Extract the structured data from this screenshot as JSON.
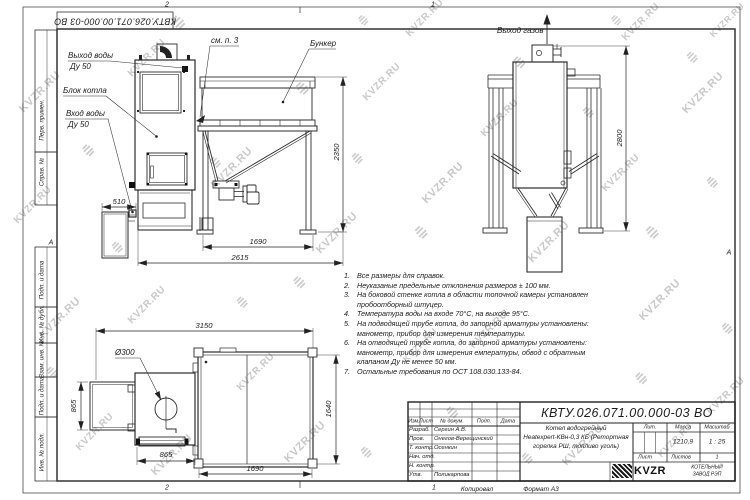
{
  "watermark": {
    "text": "KVZR.RU"
  },
  "frame": {
    "zone_top_left": "2",
    "zone_top_right": "1",
    "zone_bottom_left": "2",
    "zone_bottom_right": "1",
    "side_marker": "А",
    "left_column": [
      "Перв. примен.",
      "Справ. №",
      "Подп. и дата",
      "Инв. № дубл.",
      "Взам. инв. №",
      "Подп. и дата",
      "Инв. № подл."
    ],
    "copied_label": "Копировал",
    "format_label": "Формат А3"
  },
  "views": {
    "front": {
      "labels": {
        "water_out_1": "Выход воды",
        "water_out_2": "Ду 50",
        "boiler_block": "Блок котла",
        "water_in_1": "Вход воды",
        "water_in_2": "Ду 50",
        "see_note": "см. п. 3",
        "bunker": "Бункер"
      },
      "dims": {
        "height": "2350",
        "width_legs": "1690",
        "width_total": "2615",
        "ash_box": "510"
      }
    },
    "side": {
      "labels": {
        "gas_out": "Выход газов"
      },
      "dims": {
        "height": "2800"
      }
    },
    "plan": {
      "labels": {
        "diameter": "Ø300"
      },
      "dims": {
        "width_total": "3150",
        "depth_left": "865",
        "width_small": "865",
        "depth": "1640",
        "width_bunker": "1690"
      }
    }
  },
  "notes": {
    "items": [
      {
        "num": "1.",
        "text": "Все размеры для справок."
      },
      {
        "num": "2.",
        "text": "Неуказаные предельные отклонения размеров ± 100 мм."
      },
      {
        "num": "3.",
        "text": "На боковой стенке котла в области топочной камеры установлен пробоотборный штуцер."
      },
      {
        "num": "4.",
        "text": "Температура воды на входе 70°С, на выходе 95°С."
      },
      {
        "num": "5.",
        "text": "На подводящей трубе котла, до запорной арматуры установлены: манометр, прибор для измерения температуры."
      },
      {
        "num": "6.",
        "text": "На отводящей трубе котла, до запорной арматуры установлены: манометр, прибор для измерения емпературы, обвод с обратным клапаном Ду не менее 50 мм."
      },
      {
        "num": "7.",
        "text": "Остальные требования по ОСТ 108.030.133-84."
      }
    ]
  },
  "title_block": {
    "doc_number": "КВТУ.026.071.00.000-03 ВО",
    "header": [
      "Изм.",
      "Лист",
      "№ докум.",
      "Подп.",
      "Дата"
    ],
    "rows": [
      {
        "role": "Разраб.",
        "name": "Сергин А.В."
      },
      {
        "role": "Пров.",
        "name": "Онегов-Верещинский"
      },
      {
        "role": "Т. контр.",
        "name": "Осенкин"
      },
      {
        "role": "Нач. отд.",
        "name": ""
      },
      {
        "role": "Н. контр.",
        "name": ""
      },
      {
        "role": "Утв.",
        "name": "Поликарпова"
      }
    ],
    "product_line1": "Котел водогрейный",
    "product_line2": "Heatexpert-КВн-0,3 КБ (Ретортная",
    "product_line3": "горелка РШ, топливо уголь)",
    "lit_label": "Лит.",
    "mass_label": "Масса",
    "scale_label": "Масштаб",
    "mass": "1210,9",
    "scale": "1 : 25",
    "sheet_label": "Лист",
    "sheets_label": "Листов",
    "sheets_value": "1",
    "company": {
      "logo": "KVZR",
      "line1": "КОТЕЛЬНЫЙ",
      "line2": "ЗАВОД РЭП"
    }
  }
}
